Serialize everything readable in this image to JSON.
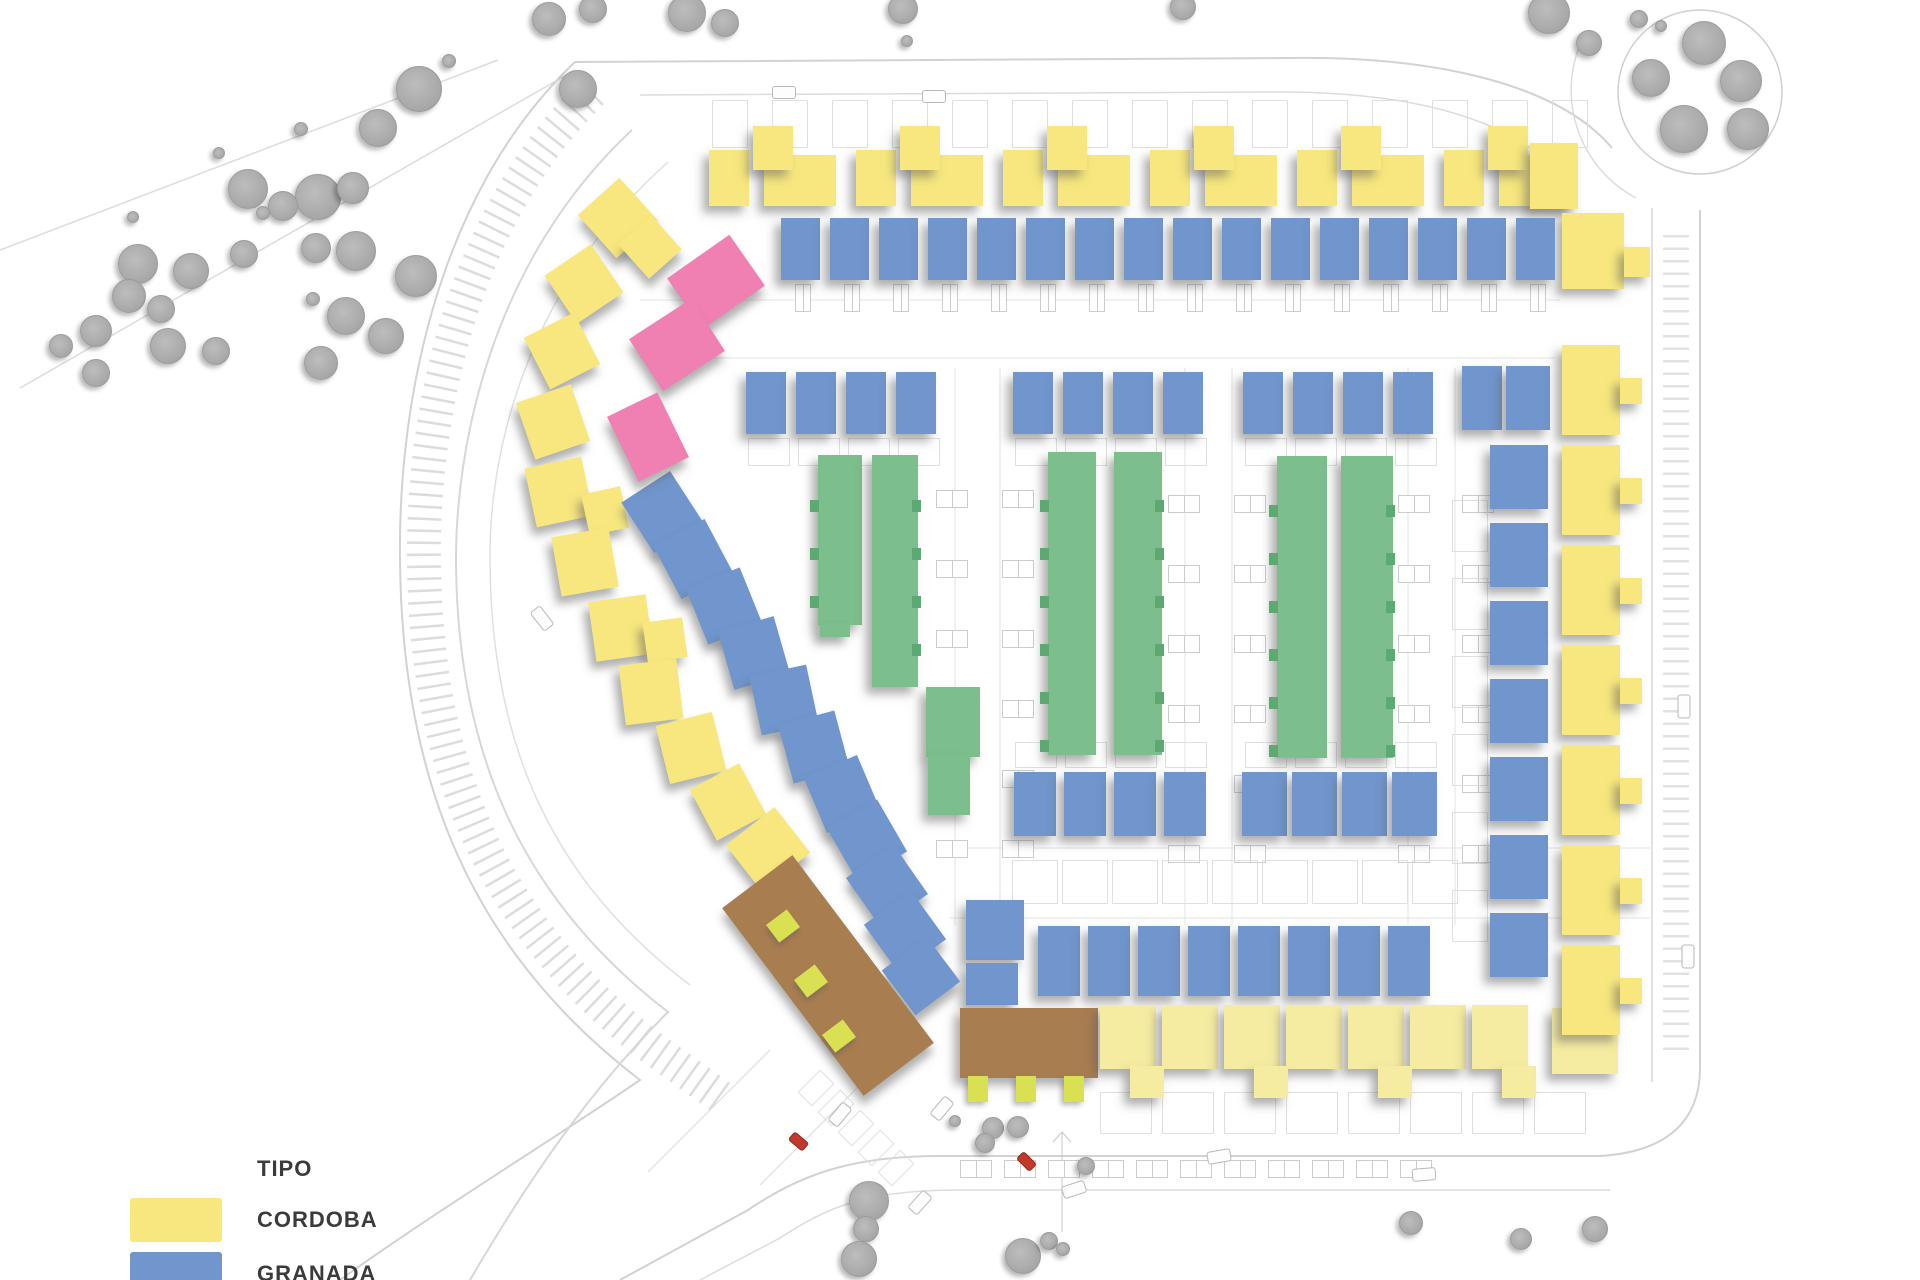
{
  "title": "Residential development site plan",
  "palette": {
    "cordoba": "#F7E77E",
    "cordoba_pale": "#F5ECA2",
    "granada": "#7096CD",
    "verde": "#7CBE8C",
    "verde_dark": "#5EA874",
    "rosa": "#EF80B1",
    "marron": "#A87D50",
    "tab": "#D9E052",
    "tree": "#AFAFAF",
    "road_line": "#D2D2D2",
    "car_red": "#C0392B",
    "text": "#3B3B3B"
  },
  "legend": {
    "title": "TIPO",
    "items": [
      {
        "id": "cordoba",
        "label": "CORDOBA",
        "color": "#F7E77E"
      },
      {
        "id": "granada",
        "label": "GRANADA",
        "color": "#7096CD"
      }
    ]
  },
  "site": {
    "width": 1920,
    "height": 1280,
    "roads": [
      {
        "d": "M 575,62 C 430,200 398,420 400,560 C 402,780 470,950 640,1080 C 560,1135 430,1215 340,1280",
        "w": 2,
        "c": "#d2d2d2"
      },
      {
        "d": "M 592,92 C 455,225 422,430 424,562 C 426,768 492,925 652,1048 L 722,1098",
        "w": 34,
        "c": "#dcdcdc",
        "da": "2.5 9.5"
      },
      {
        "d": "M 632,130 C 492,260 455,445 456,565 C 458,752 520,898 668,1012 C 600,1080 540,1160 470,1280",
        "w": 2,
        "c": "#d7d7d7"
      },
      {
        "d": "M 668,162 C 525,290 488,455 490,565 C 492,740 548,878 690,985",
        "w": 1.5,
        "c": "#e0e0e0"
      },
      {
        "d": "M 575,62 L 1290,58 C 1440,56 1560,86 1612,148",
        "w": 2,
        "c": "#d2d2d2"
      },
      {
        "d": "M 640,95 L 1280,92 C 1420,92 1520,122 1568,182",
        "w": 1.5,
        "c": "#dcdcdc"
      },
      {
        "d": "M 1652,208 L 1652,1082",
        "w": 1.5,
        "c": "#d7d7d7"
      },
      {
        "d": "M 1700,210 L 1700,1068 C 1700,1120 1668,1152 1600,1156",
        "w": 2,
        "c": "#d2d2d2"
      },
      {
        "d": "M 1600,1156 L 940,1156 C 850,1156 800,1175 748,1210 L 620,1280",
        "w": 2,
        "c": "#d2d2d2"
      },
      {
        "d": "M 1610,1190 L 960,1190 C 870,1190 830,1205 780,1238 L 700,1280",
        "w": 1.5,
        "c": "#dcdcdc"
      },
      {
        "d": "M 1676,235 L 1676,1055",
        "w": 26,
        "c": "#e2e2e2",
        "da": "2.5 10"
      },
      {
        "d": "M 1618,92 a 82,82 0 1 0 164,0 a 82,82 0 1 0 -164,0",
        "w": 1.5,
        "c": "#cfcfcf"
      },
      {
        "d": "M 1582,40 A 122,122 0 0 0 1636,198",
        "w": 1.5,
        "c": "#dcdcdc"
      },
      {
        "d": "M 0,250 L 498,60",
        "w": 1.5,
        "c": "#dcdcdc"
      },
      {
        "d": "M 20,388 L 575,70",
        "w": 1.5,
        "c": "#dcdcdc"
      },
      {
        "d": "M 640,300 L 1560,300",
        "w": 1,
        "c": "#e3e3e3"
      },
      {
        "d": "M 640,358 L 1555,358",
        "w": 1,
        "c": "#e3e3e3"
      },
      {
        "d": "M 955,368 L 955,925",
        "w": 1,
        "c": "#e3e3e3"
      },
      {
        "d": "M 1000,368 L 1000,925",
        "w": 1,
        "c": "#e3e3e3"
      },
      {
        "d": "M 1185,368 L 1185,925",
        "w": 1,
        "c": "#e3e3e3"
      },
      {
        "d": "M 1232,368 L 1232,925",
        "w": 1,
        "c": "#e3e3e3"
      },
      {
        "d": "M 1408,368 L 1408,925",
        "w": 1,
        "c": "#e3e3e3"
      },
      {
        "d": "M 1455,368 L 1455,925",
        "w": 1,
        "c": "#e3e3e3"
      },
      {
        "d": "M 950,848 L 1650,848",
        "w": 1,
        "c": "#e3e3e3"
      },
      {
        "d": "M 950,918 L 1650,918",
        "w": 1,
        "c": "#e3e3e3"
      },
      {
        "d": "M 770,1050 L 648,1172",
        "w": 1,
        "c": "#dcdcdc"
      },
      {
        "d": "M 905,1040 L 760,1185",
        "w": 1,
        "c": "#dcdcdc"
      },
      {
        "d": "M 1062,1132 L 1062,1232 M 1062,1132 L 1053,1142 M 1062,1132 L 1071,1142",
        "w": 1,
        "c": "#c9c9c9"
      }
    ],
    "elements": [
      {
        "t": "pl",
        "x": 712,
        "y": 100,
        "w": 34,
        "h": 46,
        "n": 15,
        "dx": 60
      },
      {
        "t": "y",
        "x": 709,
        "y": 150,
        "w": 40,
        "h": 56,
        "n": 6,
        "dx": 147
      },
      {
        "t": "y",
        "x": 764,
        "y": 155,
        "w": 72,
        "h": 51,
        "n": 6,
        "dx": 147
      },
      {
        "t": "y",
        "x": 753,
        "y": 126,
        "w": 40,
        "h": 44,
        "n": 6,
        "dx": 147
      },
      {
        "t": "y",
        "x": 1530,
        "y": 143,
        "w": 48,
        "h": 66
      },
      {
        "t": "y",
        "x": 1562,
        "y": 213,
        "w": 62,
        "h": 76
      },
      {
        "t": "y",
        "x": 1624,
        "y": 247,
        "w": 26,
        "h": 30
      },
      {
        "t": "b",
        "x": 781,
        "y": 218,
        "w": 39,
        "h": 62,
        "n": 16,
        "dx": 49
      },
      {
        "t": "st",
        "x": 795,
        "y": 284,
        "w": 14,
        "h": 26,
        "n": 16,
        "dx": 49
      },
      {
        "t": "b",
        "x": 746,
        "y": 372,
        "w": 40,
        "h": 62,
        "n": 4,
        "dx": 50
      },
      {
        "t": "b",
        "x": 1013,
        "y": 372,
        "w": 40,
        "h": 62,
        "n": 4,
        "dx": 50
      },
      {
        "t": "b",
        "x": 1243,
        "y": 372,
        "w": 40,
        "h": 62,
        "n": 4,
        "dx": 50
      },
      {
        "t": "b",
        "x": 1462,
        "y": 366,
        "w": 40,
        "h": 64
      },
      {
        "t": "b",
        "x": 1506,
        "y": 366,
        "w": 44,
        "h": 64
      },
      {
        "t": "g",
        "x": 818,
        "y": 455,
        "w": 44,
        "h": 170
      },
      {
        "t": "g",
        "x": 820,
        "y": 623,
        "w": 30,
        "h": 14
      },
      {
        "t": "g",
        "x": 872,
        "y": 455,
        "w": 46,
        "h": 232
      },
      {
        "t": "g",
        "x": 926,
        "y": 687,
        "w": 54,
        "h": 70
      },
      {
        "t": "g",
        "x": 928,
        "y": 755,
        "w": 42,
        "h": 60
      },
      {
        "t": "g",
        "x": 1048,
        "y": 452,
        "w": 48,
        "h": 303
      },
      {
        "t": "g",
        "x": 1114,
        "y": 452,
        "w": 48,
        "h": 303
      },
      {
        "t": "g",
        "x": 1277,
        "y": 456,
        "w": 50,
        "h": 302
      },
      {
        "t": "g",
        "x": 1341,
        "y": 456,
        "w": 52,
        "h": 302
      },
      {
        "t": "gn",
        "x": 1040,
        "y": 500,
        "w": 9,
        "h": 12,
        "n": 6,
        "dy": 48
      },
      {
        "t": "gn",
        "x": 1155,
        "y": 500,
        "w": 9,
        "h": 12,
        "n": 6,
        "dy": 48
      },
      {
        "t": "gn",
        "x": 1269,
        "y": 505,
        "w": 9,
        "h": 12,
        "n": 6,
        "dy": 48
      },
      {
        "t": "gn",
        "x": 1386,
        "y": 505,
        "w": 9,
        "h": 12,
        "n": 6,
        "dy": 48
      },
      {
        "t": "gn",
        "x": 810,
        "y": 500,
        "w": 9,
        "h": 12,
        "n": 3,
        "dy": 48
      },
      {
        "t": "gn",
        "x": 912,
        "y": 500,
        "w": 9,
        "h": 12,
        "n": 4,
        "dy": 48
      },
      {
        "t": "b",
        "x": 1014,
        "y": 772,
        "w": 42,
        "h": 64,
        "n": 4,
        "dx": 50
      },
      {
        "t": "b",
        "x": 1242,
        "y": 772,
        "w": 45,
        "h": 64,
        "n": 4,
        "dx": 50
      },
      {
        "t": "b",
        "x": 1038,
        "y": 926,
        "w": 42,
        "h": 70,
        "n": 8,
        "dx": 50
      },
      {
        "t": "b",
        "x": 966,
        "y": 900,
        "w": 58,
        "h": 60
      },
      {
        "t": "b",
        "x": 966,
        "y": 963,
        "w": 52,
        "h": 42
      },
      {
        "t": "br",
        "x": 960,
        "y": 1008,
        "w": 138,
        "h": 70
      },
      {
        "t": "tb",
        "x": 968,
        "y": 1076,
        "w": 20,
        "h": 26,
        "n": 3,
        "dx": 48
      },
      {
        "t": "yp",
        "x": 1100,
        "y": 1005,
        "w": 56,
        "h": 64,
        "n": 7,
        "dx": 62
      },
      {
        "t": "yp",
        "x": 1130,
        "y": 1066,
        "w": 34,
        "h": 32,
        "n": 4,
        "dx": 124
      },
      {
        "t": "yp",
        "x": 1552,
        "y": 1008,
        "w": 66,
        "h": 66
      },
      {
        "t": "b",
        "x": 1490,
        "y": 445,
        "w": 58,
        "h": 64,
        "n": 7,
        "dy": 78
      },
      {
        "t": "y",
        "x": 1562,
        "y": 345,
        "w": 58,
        "h": 90,
        "n": 7,
        "dy": 100
      },
      {
        "t": "y",
        "x": 1620,
        "y": 378,
        "w": 22,
        "h": 26,
        "n": 7,
        "dy": 100
      },
      {
        "t": "y",
        "x": 590,
        "y": 189,
        "w": 56,
        "h": 58,
        "r": -42
      },
      {
        "t": "y",
        "x": 628,
        "y": 224,
        "w": 44,
        "h": 46,
        "r": -42
      },
      {
        "t": "y",
        "x": 556,
        "y": 255,
        "w": 56,
        "h": 58,
        "r": -34
      },
      {
        "t": "y",
        "x": 534,
        "y": 322,
        "w": 56,
        "h": 58,
        "r": -27
      },
      {
        "t": "y",
        "x": 524,
        "y": 392,
        "w": 58,
        "h": 60,
        "r": -19
      },
      {
        "t": "y",
        "x": 530,
        "y": 462,
        "w": 58,
        "h": 60,
        "r": -12
      },
      {
        "t": "y",
        "x": 585,
        "y": 490,
        "w": 40,
        "h": 42,
        "r": -12
      },
      {
        "t": "y",
        "x": 556,
        "y": 532,
        "w": 58,
        "h": 60,
        "r": -10
      },
      {
        "t": "y",
        "x": 592,
        "y": 598,
        "w": 58,
        "h": 60,
        "r": -8
      },
      {
        "t": "y",
        "x": 645,
        "y": 620,
        "w": 40,
        "h": 40,
        "r": -8
      },
      {
        "t": "y",
        "x": 622,
        "y": 662,
        "w": 58,
        "h": 60,
        "r": -7
      },
      {
        "t": "y",
        "x": 662,
        "y": 718,
        "w": 58,
        "h": 60,
        "r": -14
      },
      {
        "t": "y",
        "x": 700,
        "y": 773,
        "w": 56,
        "h": 58,
        "r": -28
      },
      {
        "t": "y",
        "x": 737,
        "y": 820,
        "w": 62,
        "h": 58,
        "r": -38
      },
      {
        "t": "b",
        "x": 633,
        "y": 482,
        "w": 58,
        "h": 60,
        "r": -33
      },
      {
        "t": "b",
        "x": 664,
        "y": 529,
        "w": 58,
        "h": 60,
        "r": -28
      },
      {
        "t": "b",
        "x": 695,
        "y": 576,
        "w": 58,
        "h": 60,
        "r": -22
      },
      {
        "t": "b",
        "x": 725,
        "y": 623,
        "w": 58,
        "h": 60,
        "r": -16
      },
      {
        "t": "b",
        "x": 755,
        "y": 670,
        "w": 58,
        "h": 60,
        "r": -12
      },
      {
        "t": "b",
        "x": 785,
        "y": 717,
        "w": 58,
        "h": 60,
        "r": -15
      },
      {
        "t": "b",
        "x": 813,
        "y": 764,
        "w": 58,
        "h": 60,
        "r": -23
      },
      {
        "t": "b",
        "x": 838,
        "y": 810,
        "w": 58,
        "h": 60,
        "r": -30
      },
      {
        "t": "b",
        "x": 858,
        "y": 856,
        "w": 58,
        "h": 60,
        "r": -35
      },
      {
        "t": "b",
        "x": 876,
        "y": 902,
        "w": 58,
        "h": 60,
        "r": -36
      },
      {
        "t": "b",
        "x": 893,
        "y": 948,
        "w": 56,
        "h": 56,
        "r": -37
      },
      {
        "t": "p",
        "x": 678,
        "y": 251,
        "w": 76,
        "h": 62,
        "r": -35
      },
      {
        "t": "p",
        "x": 640,
        "y": 314,
        "w": 74,
        "h": 62,
        "r": -33
      },
      {
        "t": "p",
        "x": 620,
        "y": 401,
        "w": 56,
        "h": 72,
        "r": -26
      },
      {
        "t": "br",
        "x": 784,
        "y": 858,
        "w": 88,
        "h": 235,
        "r": -37
      },
      {
        "t": "tb",
        "x": 770,
        "y": 915,
        "w": 26,
        "h": 22,
        "r": -37
      },
      {
        "t": "tb",
        "x": 798,
        "y": 970,
        "w": 26,
        "h": 22,
        "r": -37
      },
      {
        "t": "tb",
        "x": 826,
        "y": 1025,
        "w": 26,
        "h": 22,
        "r": -37
      },
      {
        "t": "st",
        "x": 936,
        "y": 490,
        "w": 30,
        "h": 16,
        "n": 6,
        "dy": 70
      },
      {
        "t": "st",
        "x": 1002,
        "y": 490,
        "w": 30,
        "h": 16,
        "n": 6,
        "dy": 70
      },
      {
        "t": "st",
        "x": 1168,
        "y": 495,
        "w": 30,
        "h": 16,
        "n": 6,
        "dy": 70
      },
      {
        "t": "st",
        "x": 1234,
        "y": 495,
        "w": 30,
        "h": 16,
        "n": 6,
        "dy": 70
      },
      {
        "t": "st",
        "x": 1398,
        "y": 495,
        "w": 30,
        "h": 16,
        "n": 6,
        "dy": 70
      },
      {
        "t": "st",
        "x": 1462,
        "y": 495,
        "w": 30,
        "h": 16,
        "n": 6,
        "dy": 70
      },
      {
        "t": "pl",
        "x": 1012,
        "y": 860,
        "w": 44,
        "h": 42,
        "n": 9,
        "dx": 50
      },
      {
        "t": "pl",
        "x": 1100,
        "y": 1092,
        "w": 50,
        "h": 40,
        "n": 8,
        "dx": 62
      },
      {
        "t": "pl",
        "x": 1452,
        "y": 500,
        "w": 34,
        "h": 50,
        "n": 6,
        "dy": 78
      },
      {
        "t": "st",
        "x": 960,
        "y": 1160,
        "w": 30,
        "h": 16,
        "n": 11,
        "dx": 44
      },
      {
        "t": "pl",
        "x": 800,
        "y": 1078,
        "w": 30,
        "h": 18,
        "n": 5,
        "dx": 20,
        "dy": 20,
        "r": -45
      },
      {
        "t": "pl",
        "x": 748,
        "y": 438,
        "w": 40,
        "h": 26,
        "n": 4,
        "dx": 50
      },
      {
        "t": "pl",
        "x": 1015,
        "y": 438,
        "w": 40,
        "h": 26,
        "n": 4,
        "dx": 50
      },
      {
        "t": "pl",
        "x": 1245,
        "y": 438,
        "w": 40,
        "h": 26,
        "n": 4,
        "dx": 50
      },
      {
        "t": "pl",
        "x": 1015,
        "y": 742,
        "w": 40,
        "h": 24,
        "n": 4,
        "dx": 50
      },
      {
        "t": "pl",
        "x": 1245,
        "y": 742,
        "w": 40,
        "h": 24,
        "n": 4,
        "dx": 50
      }
    ],
    "trees": [
      [
        418,
        88,
        22
      ],
      [
        377,
        127,
        18
      ],
      [
        317,
        196,
        22
      ],
      [
        352,
        187,
        15
      ],
      [
        282,
        205,
        14
      ],
      [
        247,
        188,
        19
      ],
      [
        355,
        250,
        19
      ],
      [
        315,
        247,
        14
      ],
      [
        415,
        275,
        20
      ],
      [
        345,
        315,
        18
      ],
      [
        385,
        335,
        17
      ],
      [
        320,
        362,
        16
      ],
      [
        137,
        263,
        19
      ],
      [
        190,
        270,
        17
      ],
      [
        243,
        253,
        13
      ],
      [
        128,
        295,
        16
      ],
      [
        160,
        308,
        13
      ],
      [
        95,
        330,
        15
      ],
      [
        167,
        345,
        17
      ],
      [
        215,
        350,
        13
      ],
      [
        95,
        372,
        13
      ],
      [
        60,
        345,
        11
      ],
      [
        577,
        88,
        18
      ],
      [
        548,
        18,
        16
      ],
      [
        592,
        8,
        13
      ],
      [
        686,
        12,
        18
      ],
      [
        724,
        22,
        13
      ],
      [
        902,
        8,
        14
      ],
      [
        1182,
        6,
        12
      ],
      [
        1548,
        12,
        20
      ],
      [
        1588,
        42,
        12
      ],
      [
        1638,
        18,
        8
      ],
      [
        1660,
        25,
        5
      ],
      [
        1703,
        42,
        21
      ],
      [
        1650,
        77,
        18
      ],
      [
        1740,
        80,
        20
      ],
      [
        1683,
        128,
        23
      ],
      [
        1747,
        128,
        20
      ],
      [
        868,
        1200,
        19
      ],
      [
        865,
        1228,
        12
      ],
      [
        858,
        1258,
        17
      ],
      [
        992,
        1127,
        10
      ],
      [
        1017,
        1126,
        10
      ],
      [
        984,
        1142,
        9
      ],
      [
        1085,
        1165,
        8
      ],
      [
        1022,
        1255,
        17
      ],
      [
        1048,
        1240,
        8
      ],
      [
        1410,
        1222,
        11
      ],
      [
        1520,
        1238,
        10
      ],
      [
        1594,
        1228,
        12
      ],
      [
        300,
        128,
        6
      ],
      [
        218,
        152,
        5
      ],
      [
        132,
        216,
        5
      ],
      [
        262,
        212,
        6
      ],
      [
        312,
        298,
        6
      ],
      [
        448,
        60,
        6
      ],
      [
        906,
        40,
        5
      ],
      [
        954,
        1120,
        5
      ],
      [
        1062,
        1248,
        6
      ]
    ],
    "cars": [
      [
        772,
        86,
        0
      ],
      [
        922,
        90,
        0
      ],
      [
        530,
        612,
        52
      ],
      [
        828,
        1108,
        -50
      ],
      [
        930,
        1102,
        -50
      ],
      [
        908,
        1196,
        -48
      ],
      [
        1062,
        1183,
        -18
      ],
      [
        1207,
        1150,
        -10
      ],
      [
        1412,
        1168,
        -5
      ],
      [
        1672,
        700,
        90
      ],
      [
        1676,
        950,
        90
      ]
    ],
    "red_cars": [
      [
        793,
        1132,
        -50
      ],
      [
        1021,
        1152,
        -45
      ]
    ]
  }
}
